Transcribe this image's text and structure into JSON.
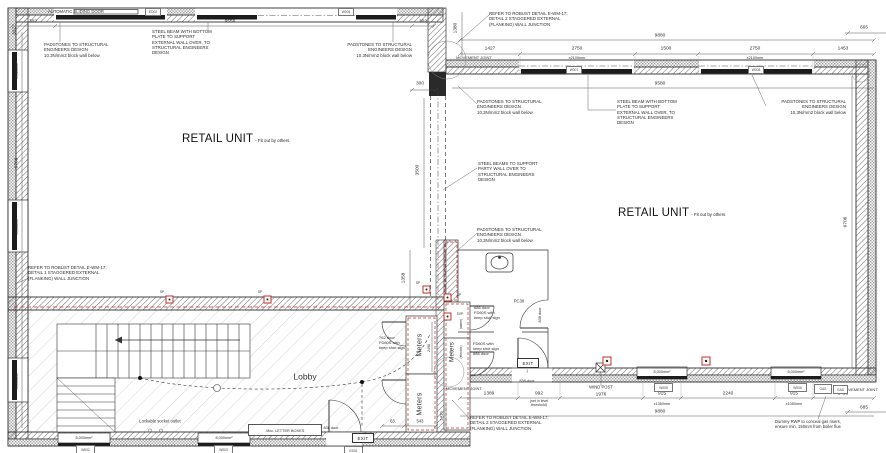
{
  "drawing": {
    "rooms": {
      "retail_unit": "RETAIL UNIT",
      "fit_out": "- Fit out by others",
      "lobby": "Lobby",
      "meters": "Meters",
      "electric": "(electric)",
      "water": "(water)"
    },
    "notes": {
      "automatic_sliding_door": "AUTOMATIC SLIDING DOOR",
      "steel_beam": "STEEL BEAM WITH BOTTOM\nPLATE TO SUPPORT\nEXTERNAL WALL OVER, TO\nSTRUCTURAL ENGINEERS\nDESIGN",
      "padstones_a": "PADSTONES TO STRUCTURAL\nENGINEERS DESIGN\n10.3N/mm2 block wall below",
      "padstones_b": "PADSTONES TO STRUCTURAL\nENGINEERS DESIGN\n10,3N/mm2 block wall below",
      "robust_detail_1": "REFER TO ROBUST DETAIL E-WM-17;\nDETAIL 1 STAGGERED EXTERNAL\n(FLANKING) WALL JUNCTION",
      "robust_detail_2": "REFER TO ROBUST DETAIL E-WM-17;\nDETAIL 2 STAGGERED EXTERNAL\n(FLANKING) WALL JUNCTION",
      "steel_beams_party": "STEEL BEAMS TO SUPPORT\nPARTY WALL OVER TO\nSTRUCTURAL ENGINEERS\nDESIGN",
      "movement_joint": "MOVEMENT JOINT",
      "wind_post": "WIND POST",
      "lockable_socket": "Lockable socket outlet",
      "letter_boxes": "4No. LETTER BOXES",
      "dummy_rwp": "Dummy RWP to conceal gas risers,\nensure min. 150mm from boiler flue",
      "set_in_level": "(set in level\nthreshold)",
      "exit": "EXIT",
      "gas": "GAS",
      "sp": "SP",
      "svp": "SVP",
      "pc30": "PC30"
    },
    "doors": {
      "d762": "762 door\nFD60S with\nkeep shut sign",
      "d686_a": "686 door\nFD60S with\nkeep shut sign",
      "d686_b": "FD60S with\nkeep shut sign\n686 door",
      "d838": "838 door",
      "d838_dash": "838-door"
    },
    "dims": {
      "d302": "302",
      "d9556": "9556",
      "d300": "300",
      "d6768": "6768",
      "w8000": "8,000mm²",
      "d1380": "1380",
      "d9880": "9880",
      "d1427": "1427",
      "d2750": "2750",
      "x2100": "x2100mm",
      "d1500": "1500",
      "d1453": "1453",
      "d665": "665",
      "d9580": "9580",
      "d6706": "6706",
      "d3500": "3500",
      "d1358": "1358",
      "d1389": "1389",
      "d992": "992",
      "d1976": "1976",
      "d915": "915",
      "x1350": "x1350mm",
      "d2240": "2240",
      "x1050": "x1050mm",
      "d685": "685",
      "d63": "63.",
      "d543": "543",
      "d2498": "2498",
      "d1410": "1410"
    },
    "tags": {
      "w002": "W002",
      "w003": "W003",
      "ed01": "ED01",
      "w005": "W005",
      "w006": "W006",
      "ed02": "ED02",
      "w004": "W004",
      "w007": "W007",
      "w008": "W008"
    },
    "colors": {
      "line": "#3a3a3a",
      "accent_red": "#c33027",
      "glazing": "#1c1c1c"
    }
  }
}
